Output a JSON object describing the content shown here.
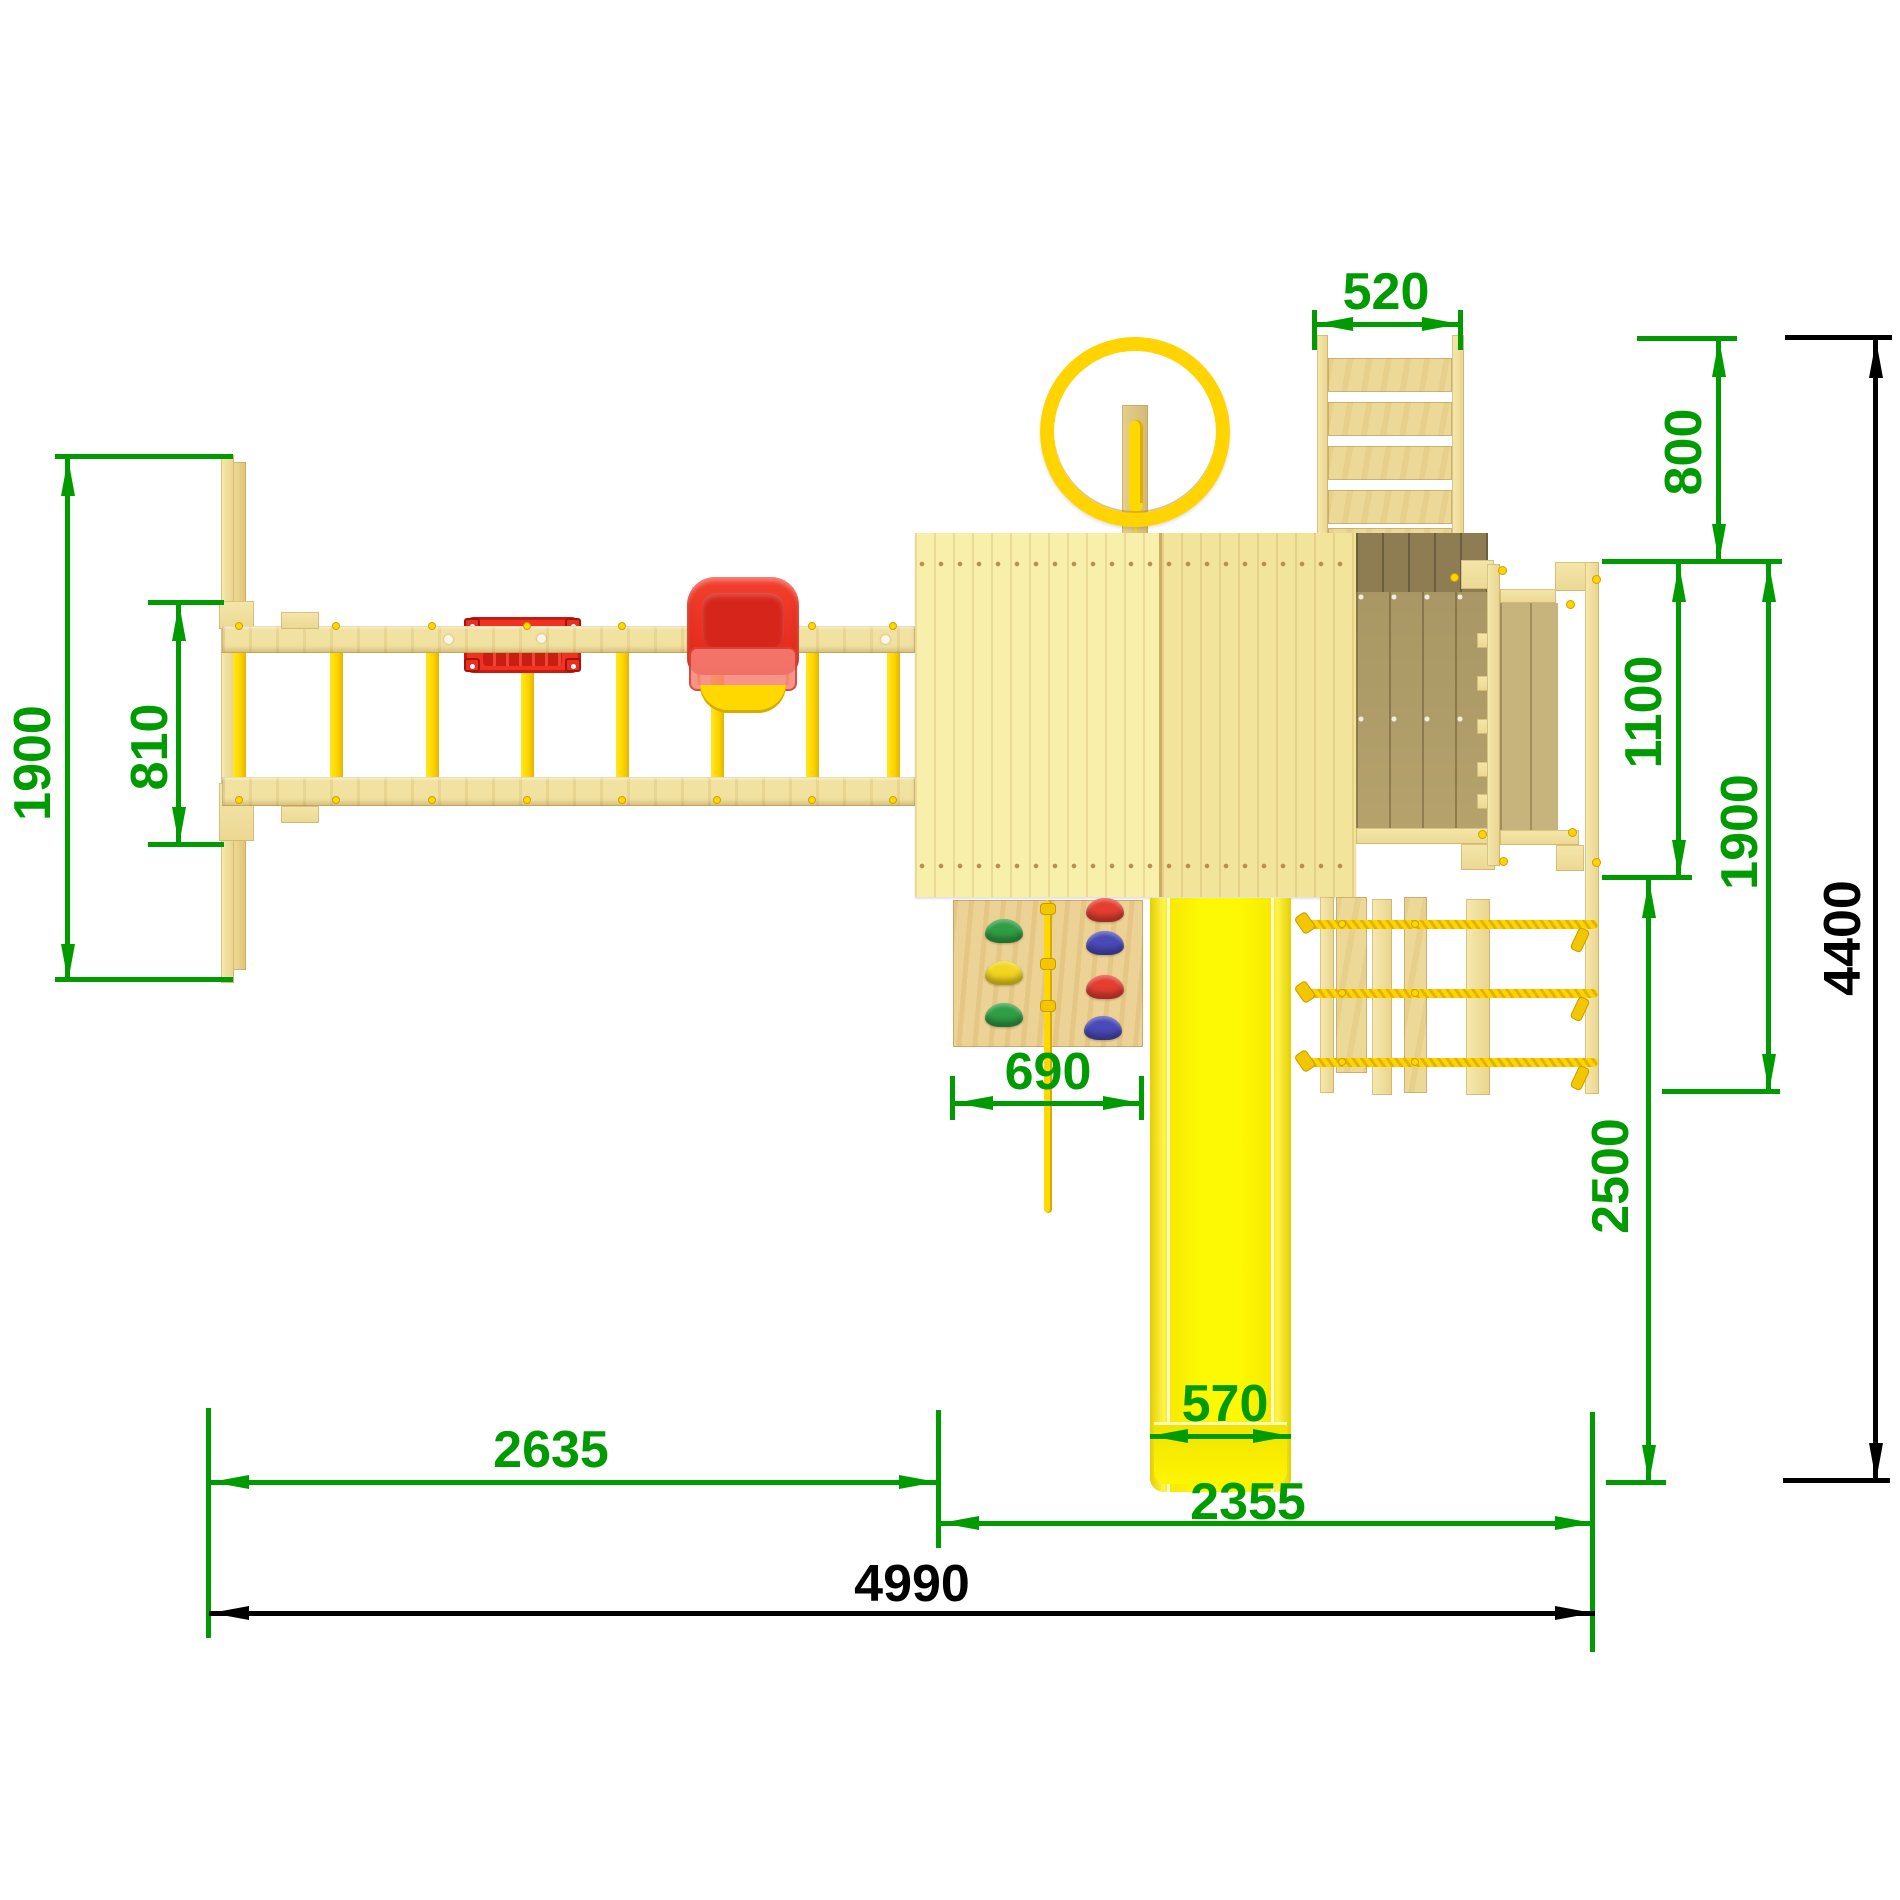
{
  "drawing": {
    "type": "technical-dimension-drawing",
    "subject": "children playground set, plan (top) view",
    "units": "mm"
  },
  "dimensions": {
    "swing_frame_depth": "1900",
    "swing_bay_width": "810",
    "top_ladder_width": "520",
    "top_ladder_run": "800",
    "platform_depth": "1100",
    "right_module_depth": "1900",
    "overall_depth": "4400",
    "climbing_wall_width": "690",
    "slide_side_depth": "2500",
    "slide_width": "570",
    "swing_section_length": "2635",
    "tower_section_length": "2355",
    "overall_length": "4990"
  },
  "colors": {
    "dimension_green": "#009b00",
    "dimension_black": "#000000",
    "wood_light": "#f2e4a4",
    "deck_olive": "#b5a26c",
    "accent_yellow": "#ffd400",
    "slide_yellow": "#fbf000",
    "seat_red": "#ee3322",
    "hold_green": "#2f9e44",
    "hold_yellow": "#f2d51e",
    "hold_red": "#e53e31",
    "hold_blue": "#4a4ab8"
  },
  "components": [
    "swing-beam",
    "swing-flat-seat",
    "baby-swing-seat",
    "a-frame-leg",
    "tower-roof",
    "steering-wheel",
    "access-ladder",
    "platform-deck",
    "climbing-wall",
    "climbing-rope",
    "rope-bridge",
    "slide"
  ]
}
